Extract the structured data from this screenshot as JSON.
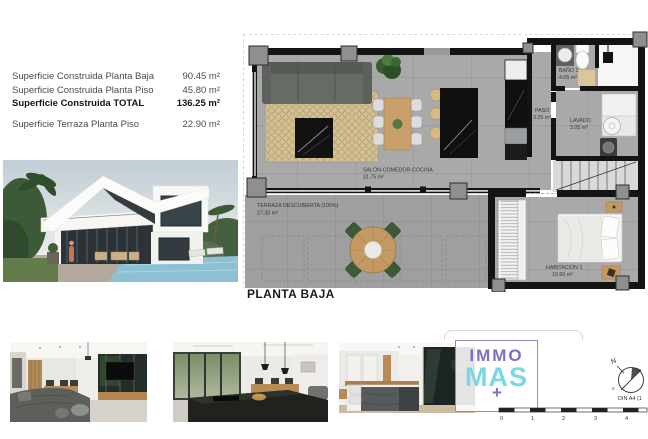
{
  "summary": {
    "rows": [
      {
        "label": "Superficie Construida Planta Baja",
        "value": "90.45 m²"
      },
      {
        "label": "Superficie Construida Planta Piso",
        "value": "45.80 m²"
      },
      {
        "label": "Superficie Construida TOTAL",
        "value": "136.25 m²"
      },
      {
        "label": "Superficie Terraza Planta Piso",
        "value": "22.90 m²"
      }
    ]
  },
  "floorplan": {
    "title": "PLANTA BAJA",
    "rooms": {
      "salon": {
        "name": "SALÓN-COMEDOR-COCINA",
        "area": "31.75 m²"
      },
      "terraza": {
        "name": "TERRAZA DESCUBIERTA (100%)",
        "area": "27.30 m²"
      },
      "paso": {
        "name": "PASO",
        "area": "3.25 m²"
      },
      "bano": {
        "name": "BAÑO 1",
        "area": "4.05 m²"
      },
      "lavado": {
        "name": "LAVADO",
        "area": "3.05 m²"
      },
      "habitacion": {
        "name": "HABITACIÓN 1",
        "area": "10.60 m²"
      }
    }
  },
  "logo": {
    "word_top": "IMMO",
    "word_bottom": "MAS",
    "plus": "+",
    "color_purple": "#7b6ec6",
    "color_cyan": "#7bd7e6"
  },
  "annotations": {
    "north_label": "N",
    "origin_label": "0",
    "din_label": "DIN A4 (1",
    "scale_ticks": [
      "0",
      "1",
      "2",
      "3",
      "4"
    ]
  }
}
